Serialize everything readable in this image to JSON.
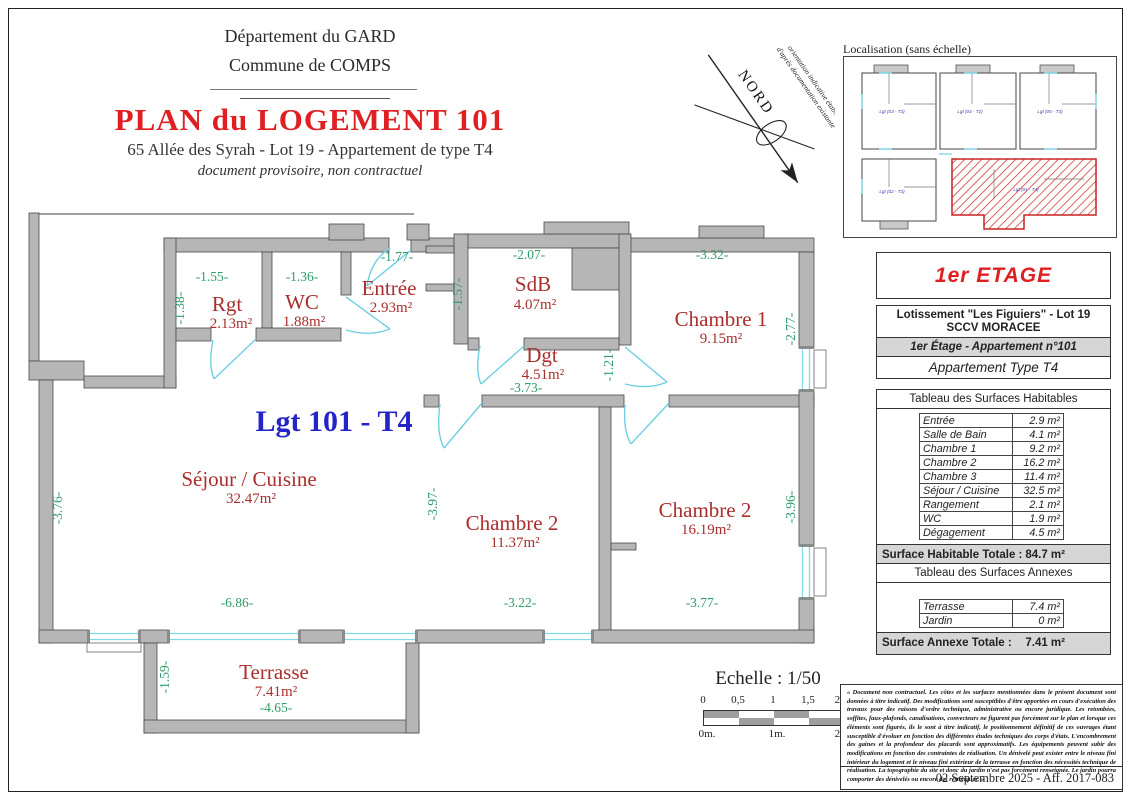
{
  "header": {
    "department": "Département du GARD",
    "commune": "Commune de COMPS",
    "title": "PLAN du LOGEMENT 101",
    "subtitle": "65 Allée des Syrah - Lot 19 - Appartement de type T4",
    "note": "document provisoire, non contractuel"
  },
  "north_arrow": {
    "caption_line1": "orientation indicative établie",
    "caption_line2": "d'après documentation existante",
    "label": "NORD"
  },
  "localisation": {
    "title": "Localisation (sans échelle)",
    "units": [
      {
        "label": "Lgt (03 - T3)"
      },
      {
        "label": "Lgt (04 - T2)"
      },
      {
        "label": "Lgt (05 - T3)"
      },
      {
        "label": "Lgt (02 - T3)"
      },
      {
        "label": "Lgt (01 - T4)"
      }
    ]
  },
  "floor_label": "1er ETAGE",
  "info_table": {
    "line1": "Lotissement \"Les Figuiers\" - Lot 19",
    "line2": "SCCV MORACEE",
    "line3": "1er Étage - Appartement n°101",
    "line4": "Appartement Type T4"
  },
  "surfaces_habitables": {
    "title": "Tableau des Surfaces Habitables",
    "rows": [
      {
        "label": "Entrée",
        "value": "2.9 m²"
      },
      {
        "label": "Salle de Bain",
        "value": "4.1 m²"
      },
      {
        "label": "Chambre 1",
        "value": "9.2 m²"
      },
      {
        "label": "Chambre 2",
        "value": "16.2 m²"
      },
      {
        "label": "Chambre 3",
        "value": "11.4 m²"
      },
      {
        "label": "Séjour / Cuisine",
        "value": "32.5 m²"
      },
      {
        "label": "Rangement",
        "value": "2.1 m²"
      },
      {
        "label": "WC",
        "value": "1.9 m²"
      },
      {
        "label": "Dégagement",
        "value": "4.5 m²"
      }
    ],
    "total_label": "Surface Habitable Totale :",
    "total_value": "84.7 m²"
  },
  "surfaces_annexes": {
    "title": "Tableau des Surfaces Annexes",
    "rows": [
      {
        "label": "Terrasse",
        "value": "7.4 m²"
      },
      {
        "label": "Jardin",
        "value": "0 m²"
      }
    ],
    "total_label": "Surface Annexe Totale :",
    "total_value": "7.41 m²"
  },
  "plan": {
    "unit_label": "Lgt 101 - T4",
    "rooms": [
      {
        "name": "Rgt",
        "area": "2.13m²"
      },
      {
        "name": "WC",
        "area": "1.88m²"
      },
      {
        "name": "Entrée",
        "area": "2.93m²"
      },
      {
        "name": "SdB",
        "area": "4.07m²"
      },
      {
        "name": "Dgt",
        "area": "4.51m²"
      },
      {
        "name": "Chambre 1",
        "area": "9.15m²"
      },
      {
        "name": "Séjour / Cuisine",
        "area": "32.47m²"
      },
      {
        "name": "Chambre 2",
        "area": "11.37m²"
      },
      {
        "name": "Chambre 2",
        "area": "16.19m²"
      },
      {
        "name": "Terrasse",
        "area": "7.41m²"
      }
    ],
    "dims": {
      "rgt_w": "-1.55-",
      "wc_w": "-1.36-",
      "entree_w": "-1.77-",
      "sdb_w": "-2.07-",
      "ch1_w": "-3.32-",
      "dgt_w": "-3.73-",
      "sejour_w": "-6.86-",
      "ch2a_w": "-3.22-",
      "ch2b_w": "-3.77-",
      "terrasse_w": "-4.65-",
      "rgt_h": "-1.38-",
      "sdb_h": "-1.57-",
      "ch1_h": "-2.77-",
      "dgt_door_h": "-1.21-",
      "sejour_h": "-3.76-",
      "ch2a_h": "-3.97-",
      "ch2b_h": "-3.96-",
      "terrasse_h": "-1.59-"
    }
  },
  "scale": {
    "title": "Echelle : 1/50",
    "ticks": [
      "0",
      "0,5",
      "1",
      "1,5",
      "2m."
    ],
    "bottom_labels": [
      "0m.",
      "1m.",
      "2m."
    ]
  },
  "footer": {
    "disclaimer": "« Document non contractuel. Les côtes et les surfaces mentionnées dans le présent document sont données à titre indicatif. Des modifications sont susceptibles d'être apportées en cours d'exécution des travaux pour des raisons d'ordre technique, administrative ou encore juridique. Les retombées, soffites, faux-plafonds, canalisations, convecteurs ne figurent pas forcément sur le plan et lorsque ces éléments sont figurés, ils le sont à titre indicatif, le positionnement définitif de ces ouvrages étant susceptible d'évoluer en fonction des différentes études techniques des corps d'états. L'encombrement des gaines et la profondeur des placards sont approximatifs. Les équipements peuvent subir des modifications en fonction des contraintes de réalisation. Un dénivelé peut exister entre le niveau fini intérieur du logement et le niveau fini extérieur de la terrasse en fonction des nécessités technique de réalisation. La topographie du site et donc du jardin n'est pas forcément renseignée. Le jardin pourra comporter des dénivelés ou encore des restanques. »",
    "date": "02 Septembre 2025 - Aff. 2017-083"
  },
  "colors": {
    "title_red": "#df1f22",
    "room_red": "#aa2e2e",
    "dim_green": "#2f9c6a",
    "unit_blue": "#2424c8",
    "wall_gray": "#b6b6b6",
    "door_cyan": "#7fd9e8",
    "hatch_red": "#d43a3a",
    "total_row_gray": "#d6d6d6"
  }
}
